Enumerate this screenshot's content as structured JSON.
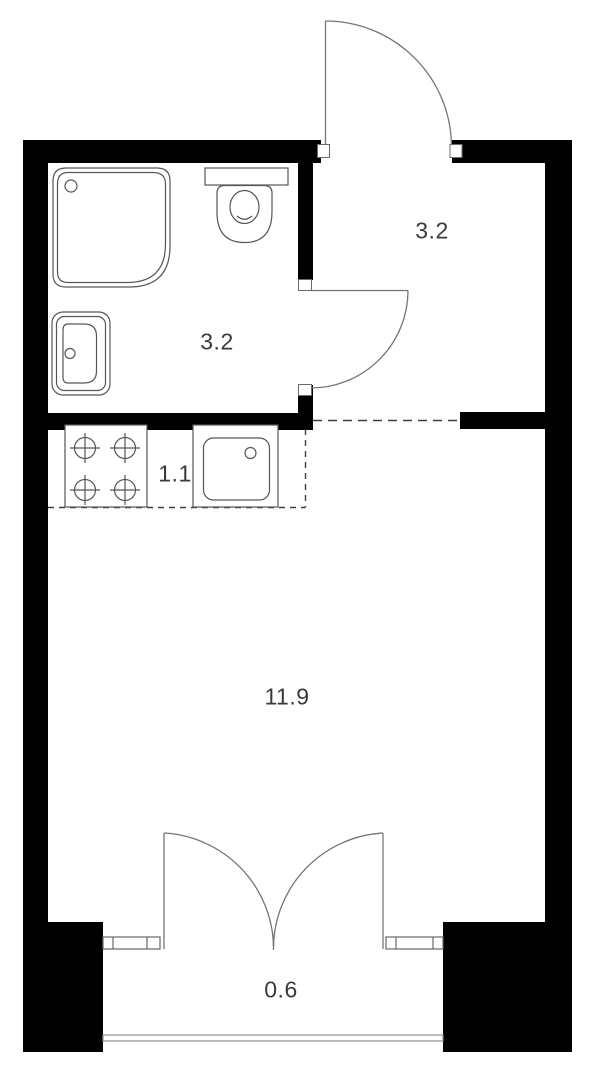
{
  "plan": {
    "type": "floor-plan",
    "description": "Studio apartment floor plan with area labels in square meters",
    "rooms": [
      {
        "id": "hallway",
        "area_label": "3.2"
      },
      {
        "id": "bathroom",
        "area_label": "3.2"
      },
      {
        "id": "kitchen-niche",
        "area_label": "1.1"
      },
      {
        "id": "living-room",
        "area_label": "11.9"
      },
      {
        "id": "balcony",
        "area_label": "0.6"
      }
    ],
    "fixtures": [
      "entrance-door",
      "bathroom-door",
      "balcony-double-door",
      "shower-tray",
      "toilet",
      "washbasin",
      "stove-4-burner",
      "kitchen-sink",
      "window-left",
      "window-right",
      "balcony-railing"
    ],
    "colors": {
      "wall": "#000000",
      "fixture_line": "#565656",
      "door_line": "#757575",
      "dashed_line": "#3f3f3f",
      "railing_line": "#8f8f8f",
      "label_text": "#3a3a3a",
      "background": "#ffffff"
    }
  }
}
